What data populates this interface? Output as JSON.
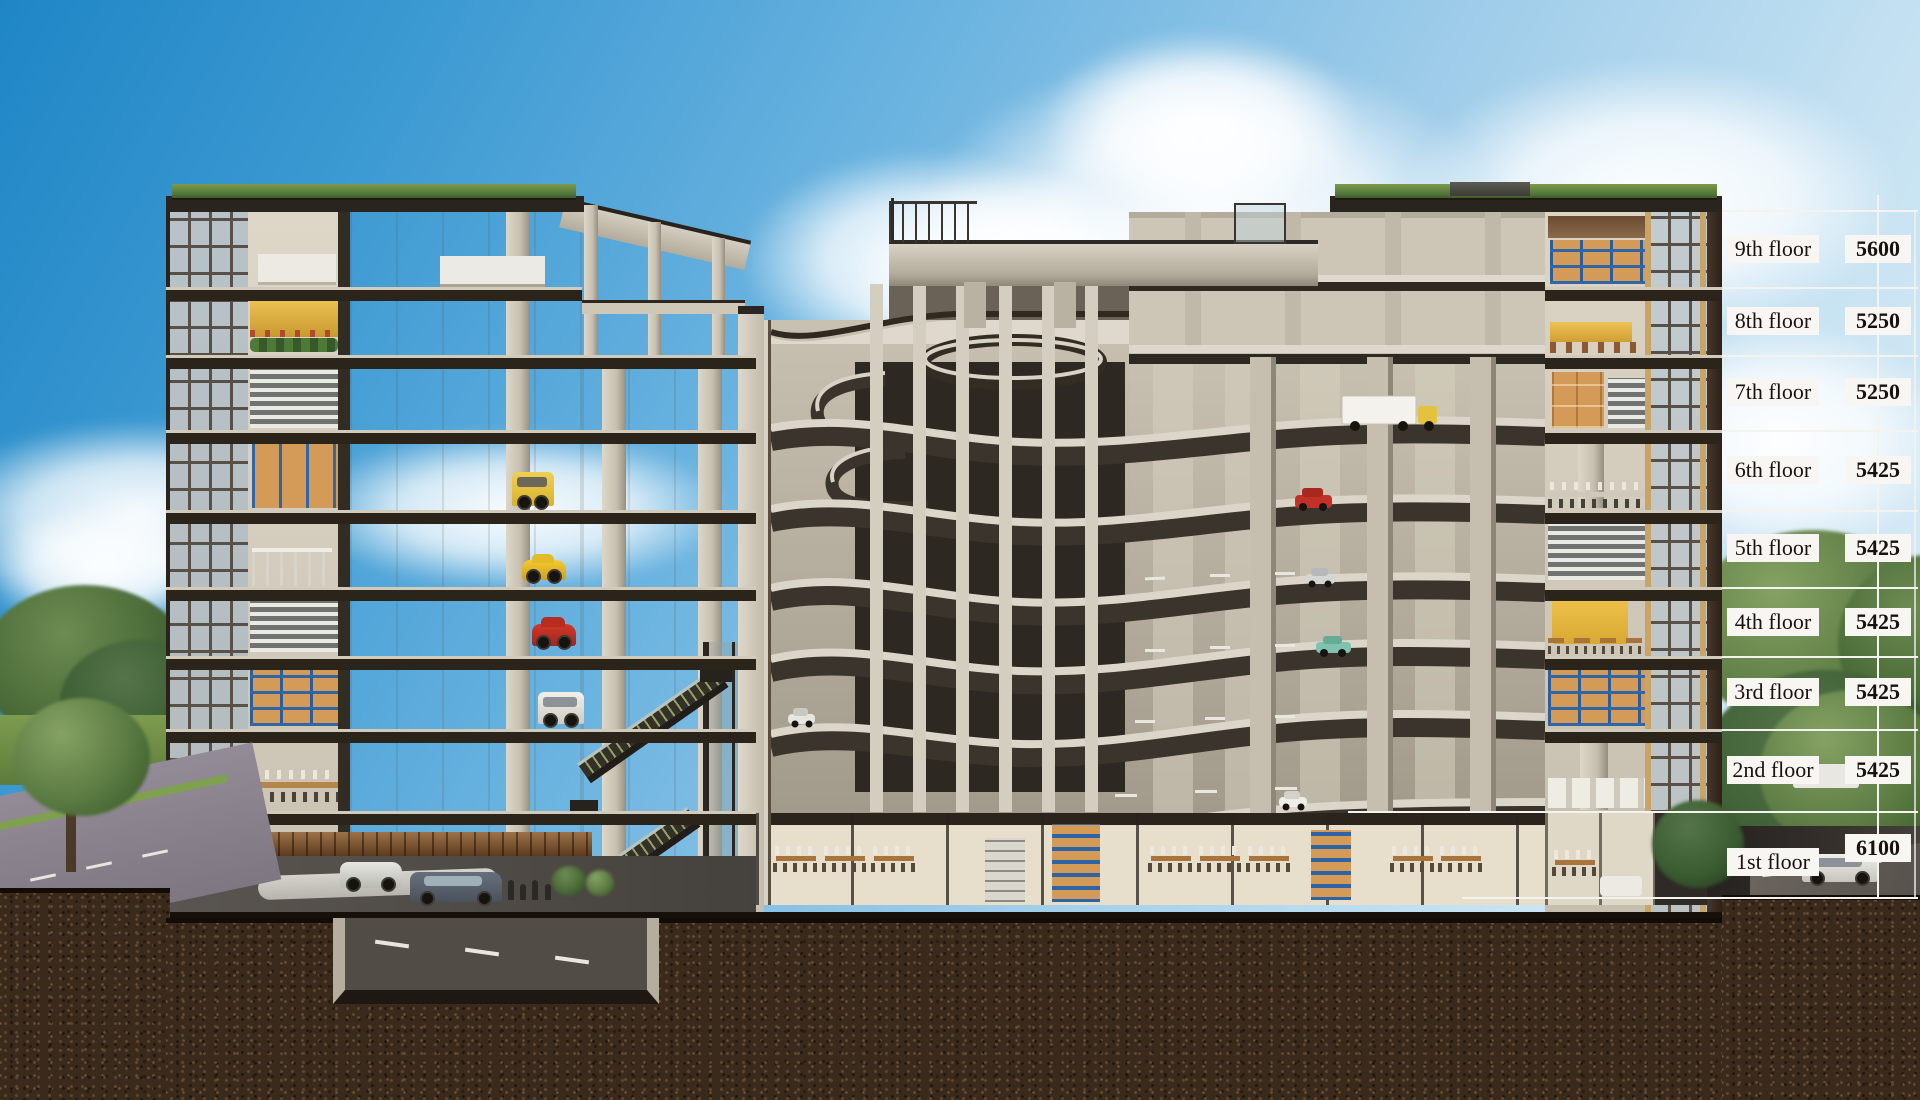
{
  "annotation": {
    "floors": [
      {
        "label": "9th floor",
        "value": "5600"
      },
      {
        "label": "8th floor",
        "value": "5250"
      },
      {
        "label": "7th floor",
        "value": "5250"
      },
      {
        "label": "6th floor",
        "value": "5425"
      },
      {
        "label": "5th floor",
        "value": "5425"
      },
      {
        "label": "4th floor",
        "value": "5425"
      },
      {
        "label": "3rd floor",
        "value": "5425"
      },
      {
        "label": "2nd floor",
        "value": "5425"
      },
      {
        "label": "1st floor",
        "value": "6100"
      }
    ]
  },
  "palette": {
    "sky_top": "#1f86c6",
    "sky_horizon": "#e2f0f8",
    "soil": "#3a2a1c",
    "concrete": "#c9c2b3",
    "slab": "#2b241b",
    "annotation_line": "#f4f3ef",
    "label_bg": "#f8f6f2",
    "label_text": "#17120d"
  }
}
